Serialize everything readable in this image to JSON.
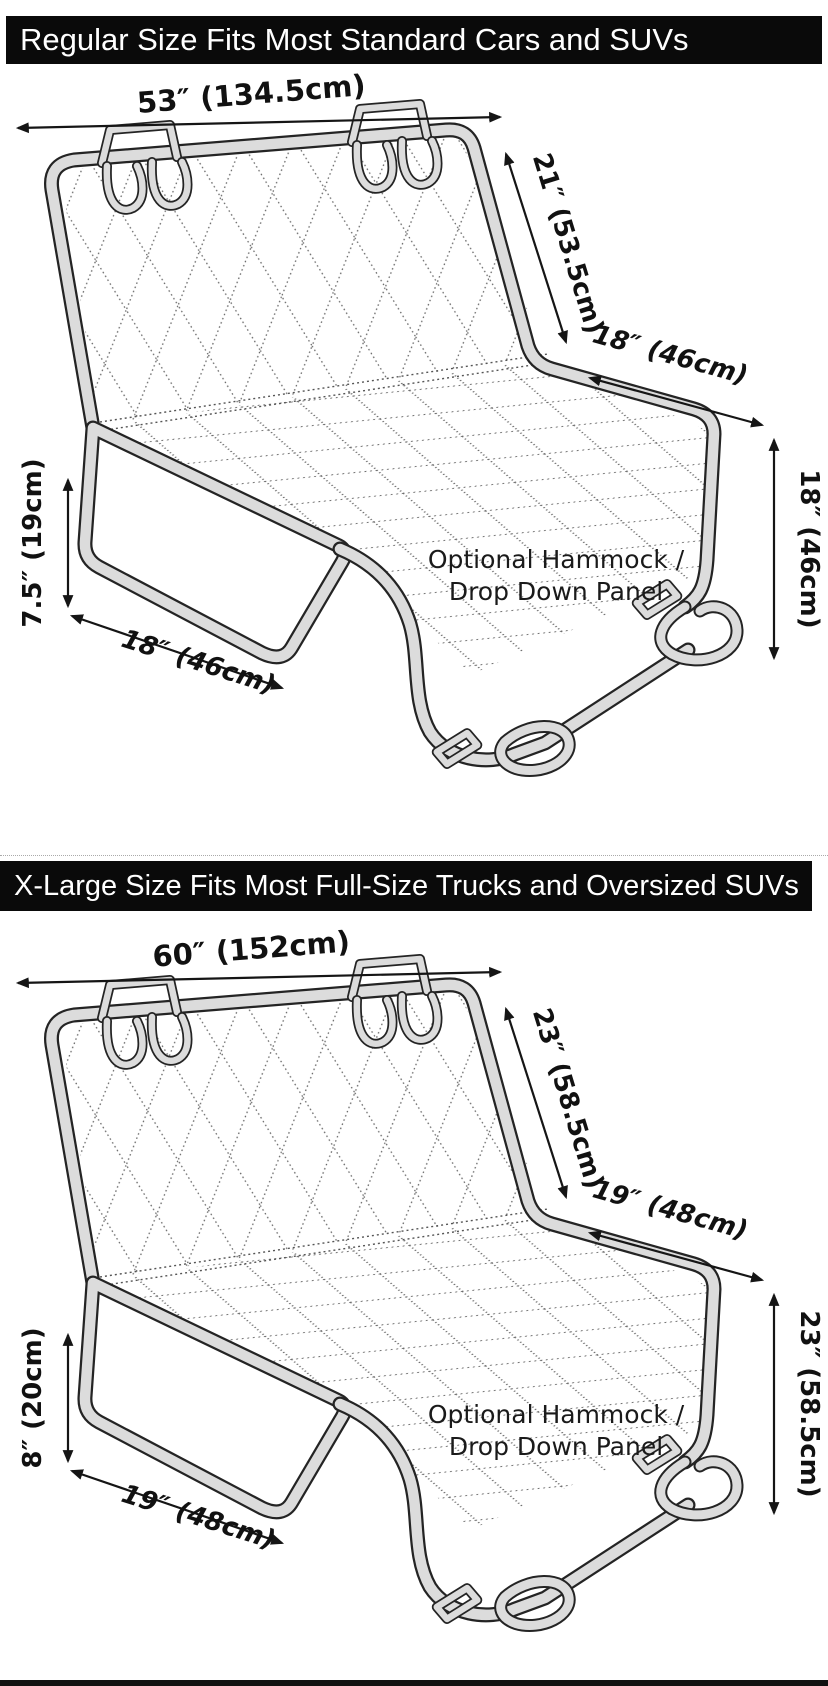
{
  "banners": {
    "regular": "Regular Size Fits Most Standard Cars and SUVs",
    "xlarge": "X-Large Size Fits Most Full-Size Trucks and Oversized SUVs"
  },
  "diagrams": [
    {
      "top_width": "53″ (134.5cm)",
      "back_height": "21″ (53.5cm)",
      "seat_depth": "18″ (46cm)",
      "side_drop": "18″ (46cm)",
      "flap_height": "7.5″ (19cm)",
      "flap_width": "18″ (46cm)",
      "hammock_line1": "Optional Hammock /",
      "hammock_line2": "Drop Down Panel"
    },
    {
      "top_width": "60″ (152cm)",
      "back_height": "23″ (58.5cm)",
      "seat_depth": "19″ (48cm)",
      "side_drop": "23″ (58.5cm)",
      "flap_height": "8″ (20cm)",
      "flap_width": "19″ (48cm)",
      "hammock_line1": "Optional Hammock /",
      "hammock_line2": "Drop Down Panel"
    }
  ],
  "colors": {
    "banner_bg": "#0a0a0a",
    "banner_text": "#ffffff",
    "tube_fill": "#dcdcdc",
    "outline": "#242424",
    "quilt_dots": "#666666"
  }
}
